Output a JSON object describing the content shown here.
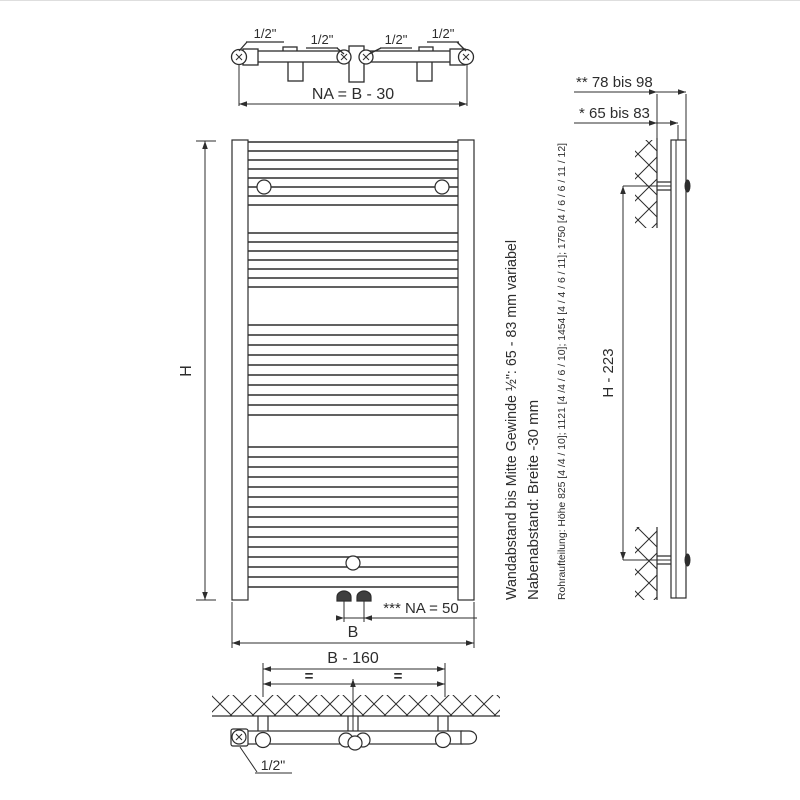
{
  "labels": {
    "top_view": {
      "half_inch_1": "1/2\"",
      "half_inch_2": "1/2\"",
      "half_inch_3": "1/2\"",
      "half_inch_4": "1/2\"",
      "na_dim": "NA = B - 30"
    },
    "front_view": {
      "height_dim": "H",
      "width_dim": "B",
      "na50_dim": "*** NA = 50"
    },
    "side_view": {
      "wall_dist_outer": "** 78 bis 98",
      "wall_dist_inner": "* 65 bis 83",
      "height_dim": "H - 223"
    },
    "bottom_view": {
      "width_dim": "B - 160",
      "equal_left": "=",
      "equal_right": "=",
      "half_inch": "1/2\""
    },
    "notes": {
      "wall_distance_note_line1": "Wandabstand bis Mitte Gewinde ½\": 65 - 83 mm variabel",
      "wall_distance_note_line2": "Nabenabstand: Breite -30 mm",
      "pipe_layout_note": "Rohraufteilung: Höhe 825 [4 /4 / 10]; 1121 [4 /4 / 6 / 10]; 1454 [4 / 4 / 6 / 11]; 1750 [4 / 6 / 6 / 11 / 12]"
    }
  },
  "colors": {
    "line": "#2d2d2d",
    "background": "#ffffff"
  }
}
